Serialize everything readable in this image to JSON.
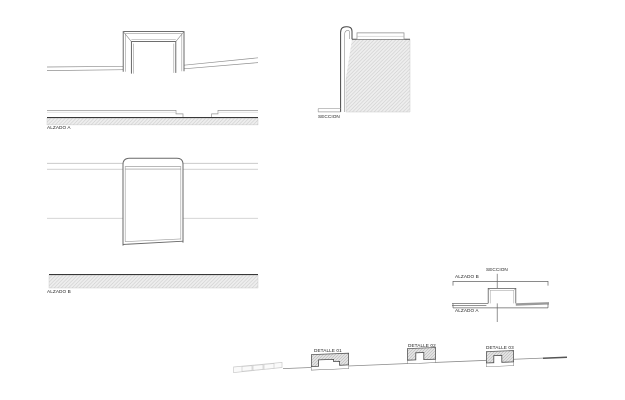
{
  "sheet": {
    "type": "architectural-detail-sheet",
    "background": "#ffffff",
    "ink_color": "#4c4c4c",
    "dark_line_color": "#383838",
    "light_line_color": "#c9c9c9",
    "hatch_fill": "#ececec",
    "hatch_stroke": "#c4c4c4"
  },
  "labels": {
    "alzado_a": "ALZADO A",
    "alzado_b": "ALZADO B",
    "seccion": "SECCION"
  },
  "key_diagram": {
    "top_label": "ALZADO B",
    "section_label": "SECCION",
    "bottom_label": "ALZADO A"
  },
  "details": [
    {
      "label": "DETALLE 01"
    },
    {
      "label": "DETALLE 02"
    },
    {
      "label": "DETALLE 03"
    }
  ]
}
